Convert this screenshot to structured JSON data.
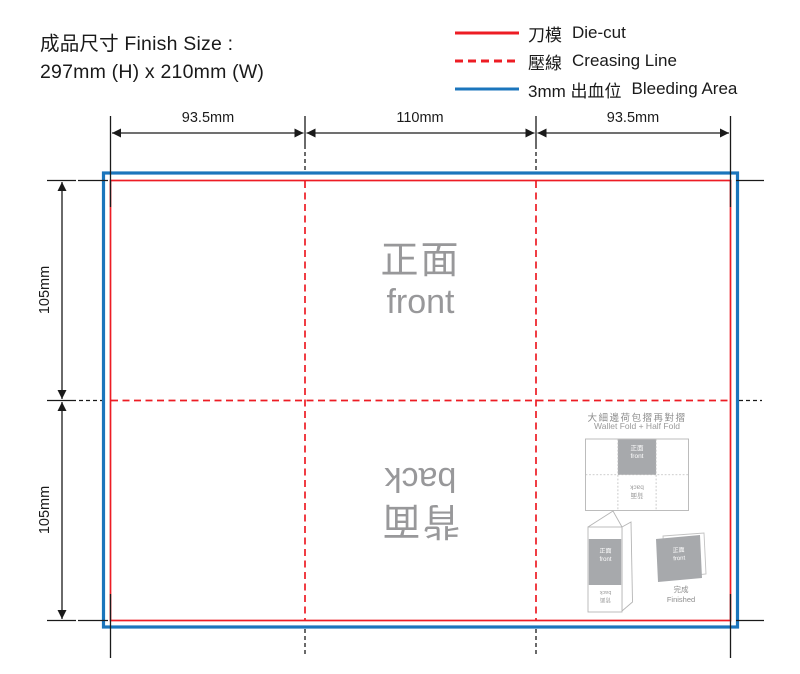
{
  "header": {
    "finish_size_label": "成品尺寸 Finish Size :",
    "finish_size_value": "297mm (H) x 210mm (W)"
  },
  "legend": {
    "items": [
      {
        "zh": "刀模",
        "en": "Die-cut"
      },
      {
        "zh": "壓線",
        "en": "Creasing Line"
      },
      {
        "zh": "3mm 出血位",
        "en": "Bleeding Area"
      }
    ]
  },
  "dimensions": {
    "top": [
      "93.5mm",
      "110mm",
      "93.5mm"
    ],
    "left": [
      "105mm",
      "105mm"
    ]
  },
  "panels": {
    "front": {
      "zh": "正面",
      "en": "front"
    },
    "back": {
      "zh": "背面",
      "en": "back"
    }
  },
  "mini_guide": {
    "title_zh": "大細邊荷包摺再對摺",
    "title_en": "Wallet Fold + Half Fold",
    "front": {
      "zh": "正面",
      "en": "front"
    },
    "back": {
      "zh": "背面",
      "en": "back"
    },
    "finished": {
      "zh": "完成",
      "en": "Finished"
    }
  },
  "colors": {
    "die_cut": "#ED1C24",
    "creasing_line": "#ED1C24",
    "bleeding_area": "#1B75BC",
    "marks": "#1A1A1A",
    "panel_text": "#98989A",
    "mini_fill": "#A7A9AC"
  }
}
